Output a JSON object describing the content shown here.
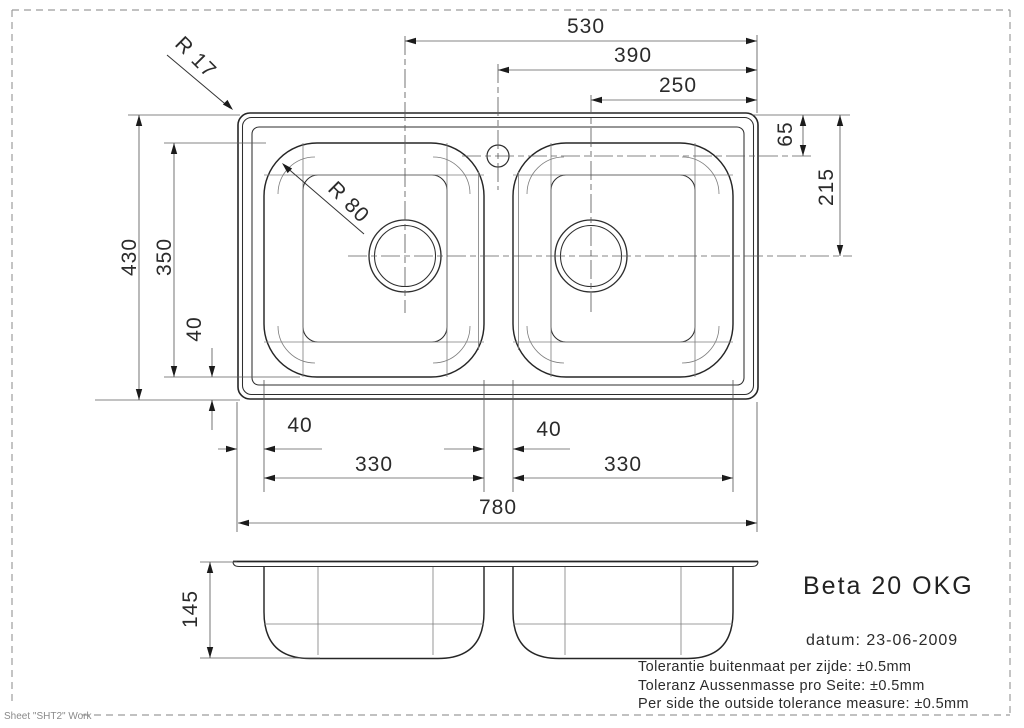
{
  "drawing": {
    "type": "technical-drawing",
    "subject": "double-bowl kitchen sink, top view and front elevation",
    "colors": {
      "outline": "#262626",
      "thin_line": "#7d7d7d",
      "dimension_line": "#5c5c5c",
      "arrow": "#1b1b1b",
      "page_border": "#9c9c9c",
      "text": "#2b2b2b",
      "background": "#ffffff"
    }
  },
  "dims": {
    "d530": "530",
    "d390": "390",
    "d250": "250",
    "d65": "65",
    "d215": "215",
    "d430": "430",
    "d350": "350",
    "d40_side": "40",
    "d40_bottom_left": "40",
    "d40_bottom_mid": "40",
    "d330_left": "330",
    "d330_right": "330",
    "d780": "780",
    "d145": "145",
    "r17": "R 17",
    "r80": "R 80"
  },
  "title_block": {
    "model": "Beta 20 OKG",
    "date_line": "datum: 23-06-2009",
    "tolerances": [
      "Tolerantie buitenmaat per zijde: ±0.5mm",
      "Toleranz Aussenmasse pro Seite: ±0.5mm",
      "Per side the outside tolerance measure: ±0.5mm"
    ]
  },
  "sheet_label": "Sheet \"SHT2\" Work"
}
